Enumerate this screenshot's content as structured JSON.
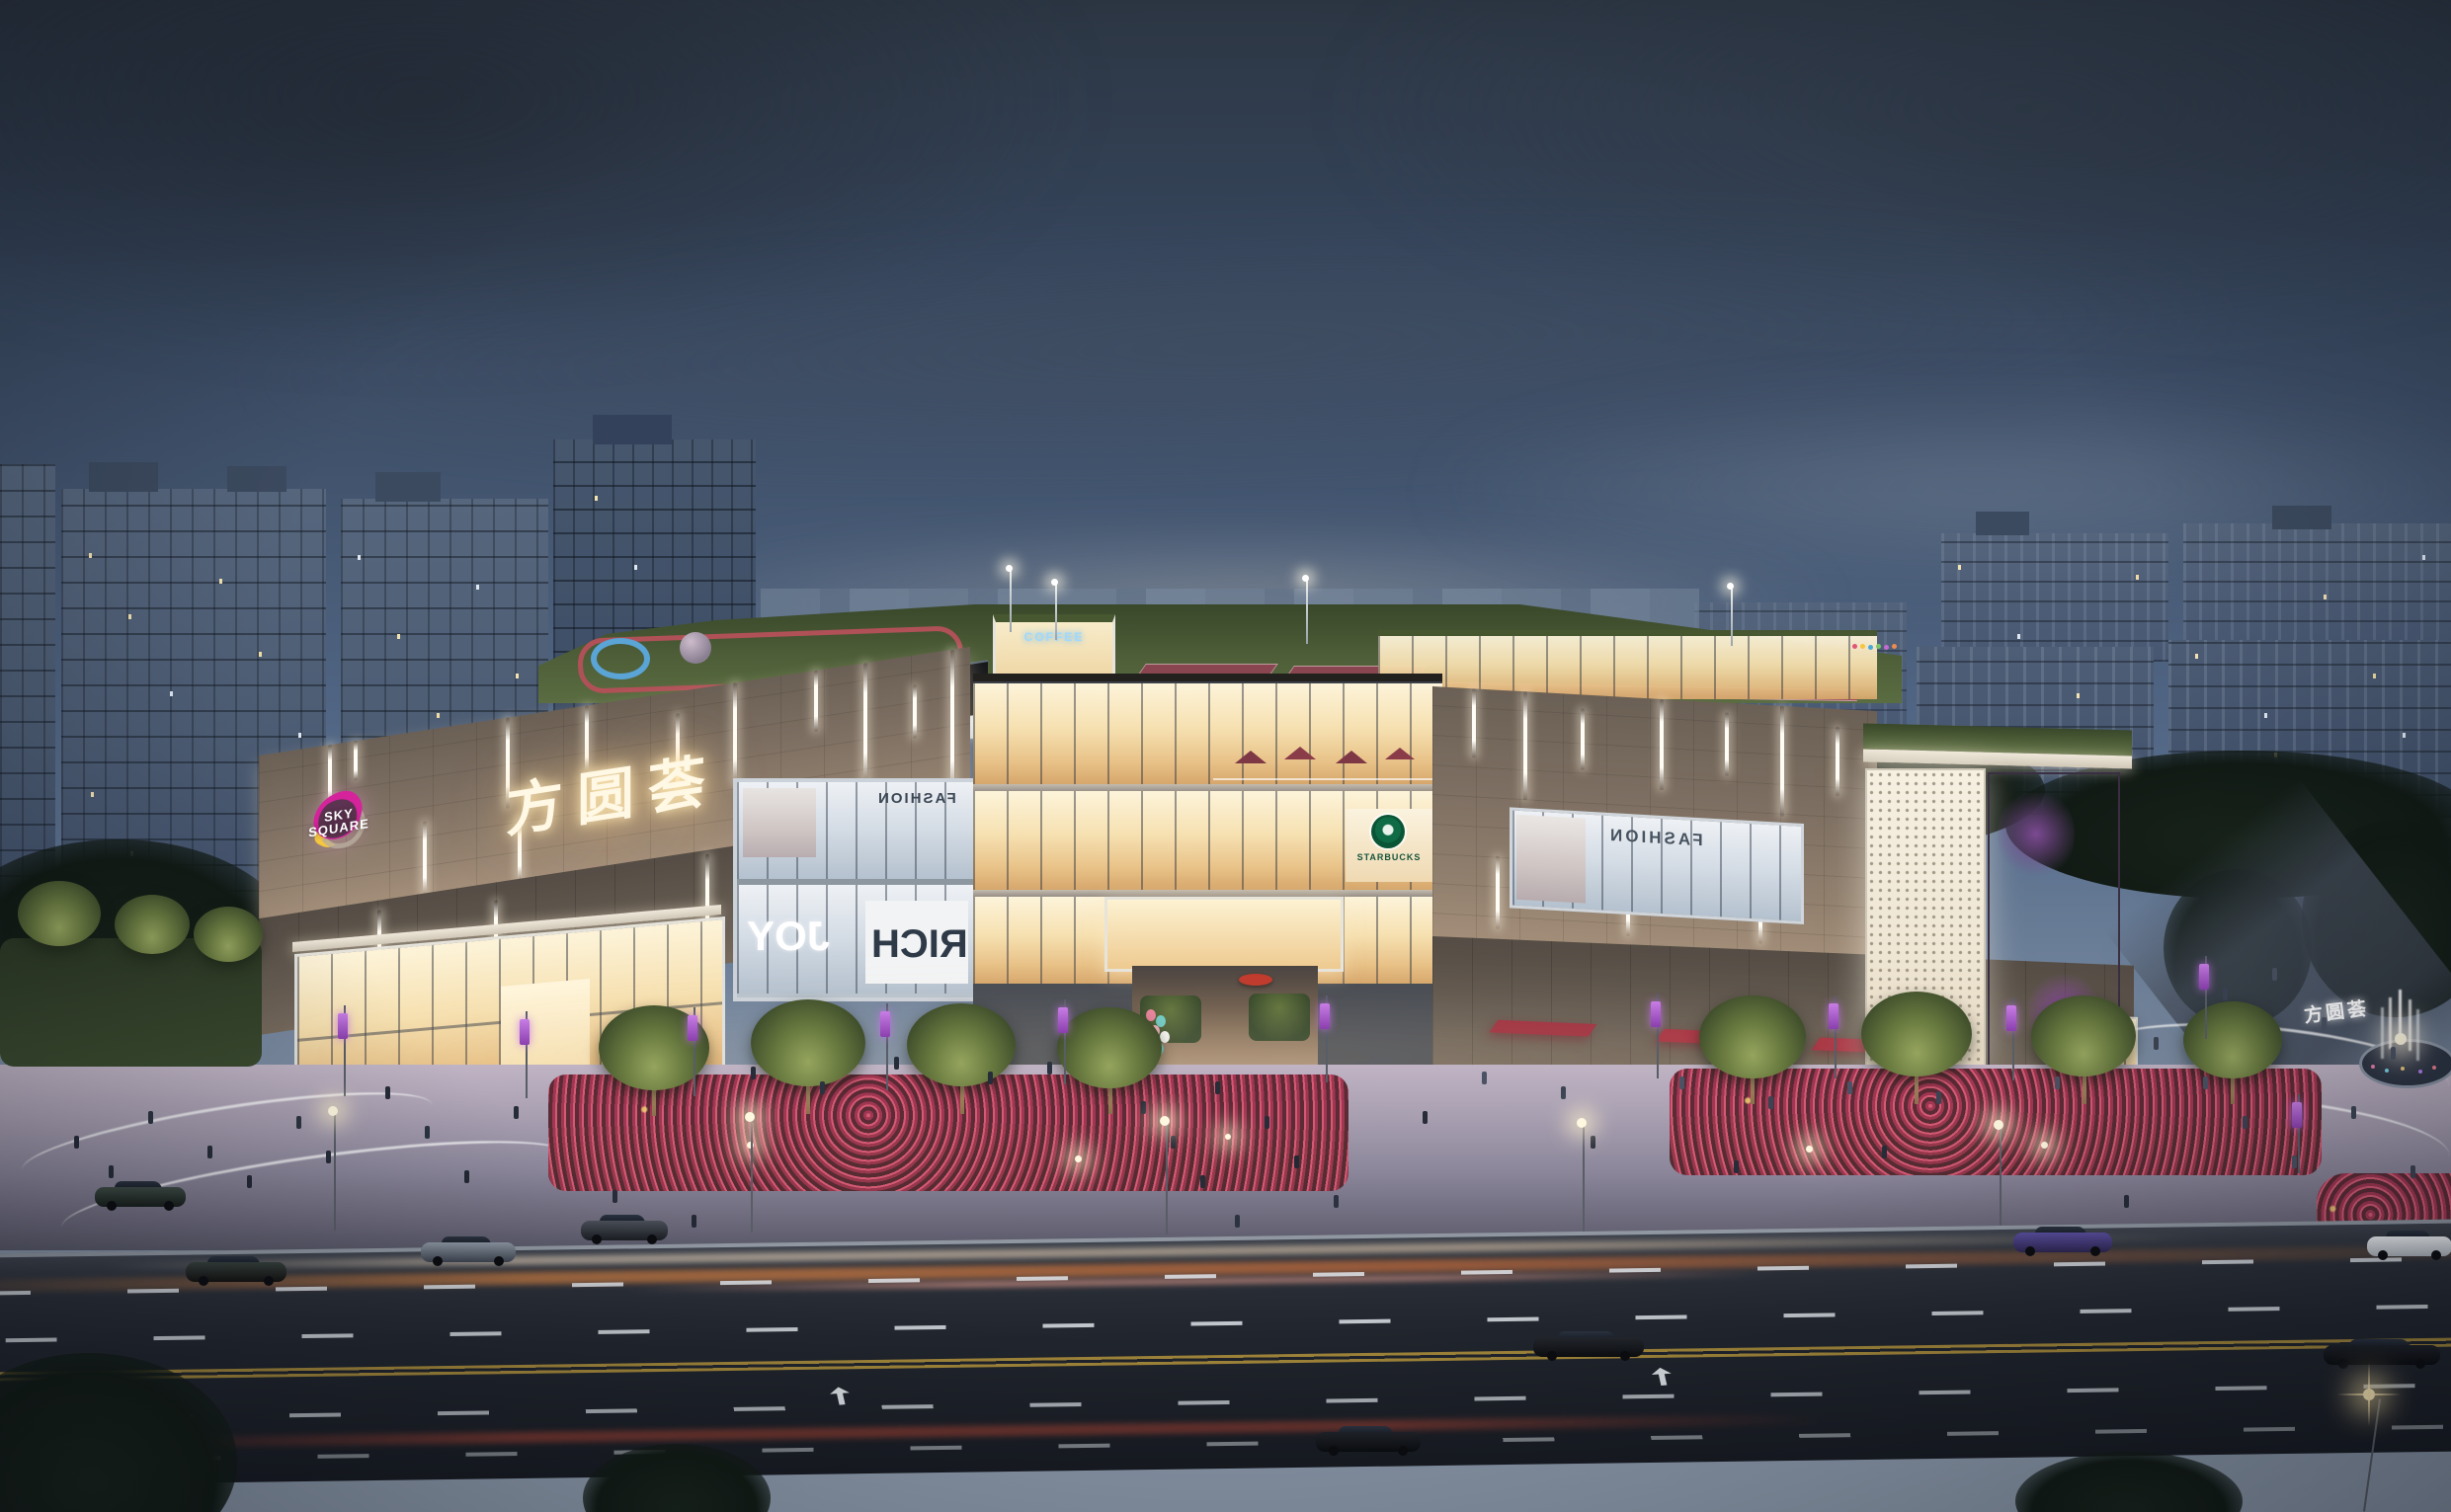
{
  "scene_title": "Sky Square mixed-use mall — dusk architectural rendering",
  "branding": {
    "logo_line1": "SKY",
    "logo_line2": "SQUARE",
    "chinese_name": "方圆荟"
  },
  "storefronts": {
    "fashion_label": "FASHION",
    "joy_label": "JOY",
    "rich_label": "RICH",
    "starbucks_label": "STARBUCKS",
    "coffee_label": "COFFEE"
  },
  "colors": {
    "sky_top": "#2c3643",
    "sky_horizon": "#8593a6",
    "facade_taupe": "#93816f",
    "glass_warm": "#f6e0b0",
    "led_screen_purple": "#a85cbf",
    "logo_magenta": "#d4239b",
    "logo_yellow": "#f5c63f",
    "logo_plum": "#5c3350",
    "roof_green": "#50613a",
    "track_red": "#a84b50",
    "awning_red": "#a52f3f",
    "banner_purple": "#9a4fc0",
    "flower_pink": "#d45a74",
    "starbucks_green": "#0e6b45"
  }
}
